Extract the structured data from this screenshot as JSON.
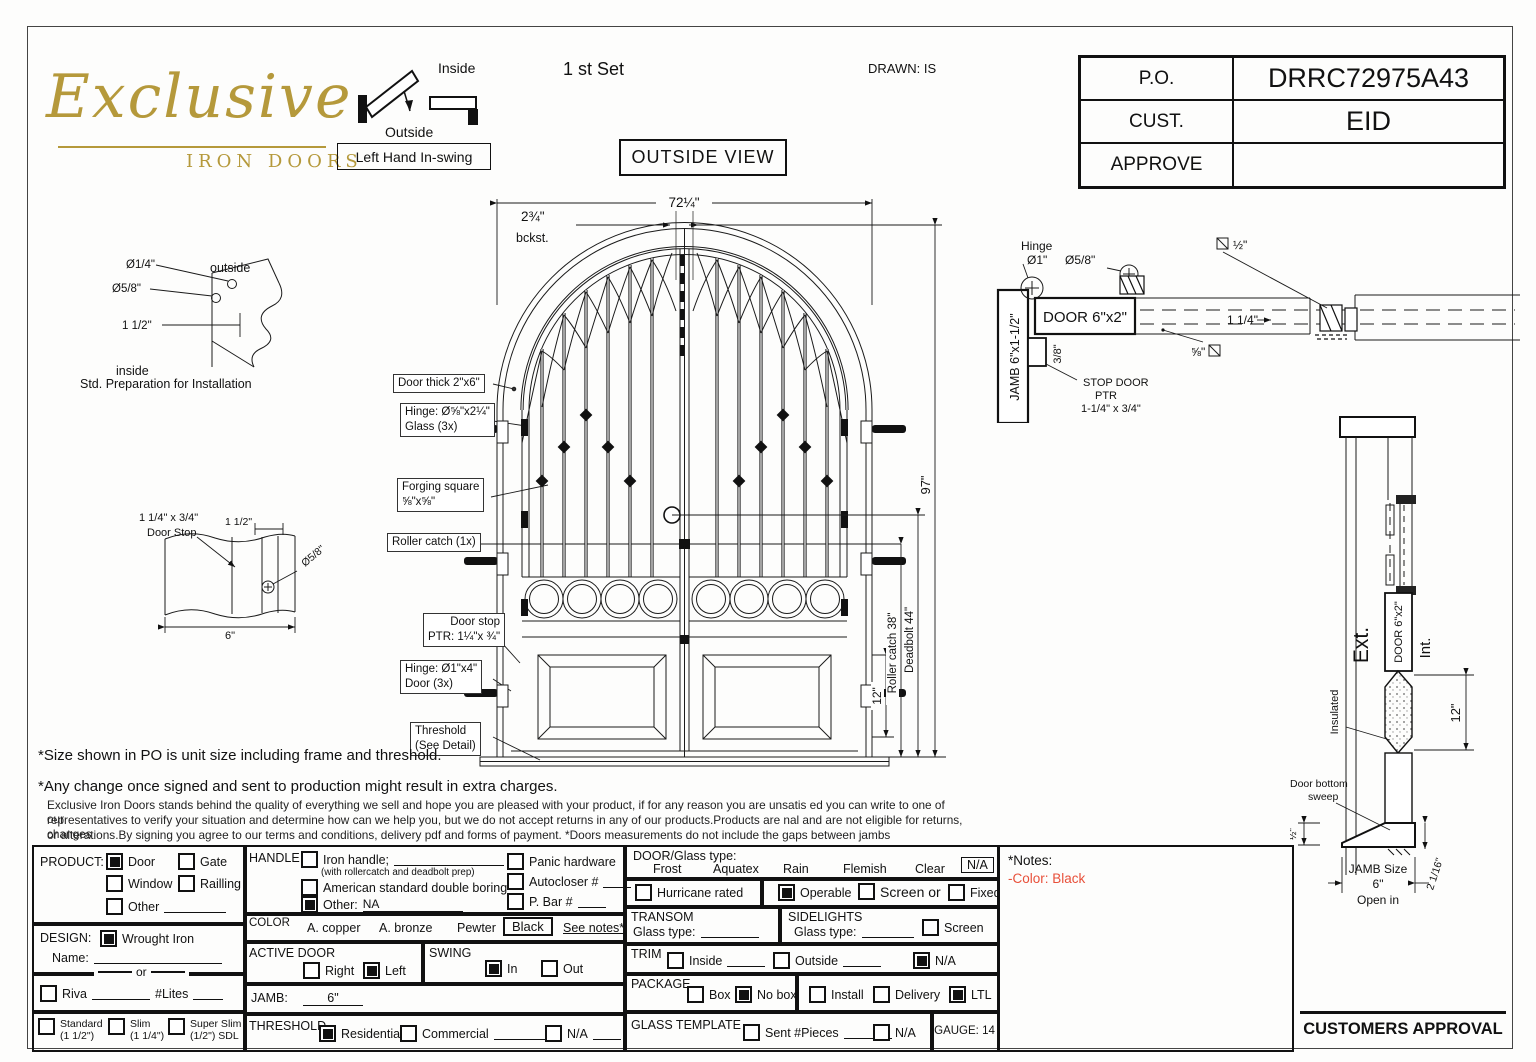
{
  "logo": {
    "script": "Exclusive",
    "sub": "IRON DOORS"
  },
  "swing_diagram": {
    "inside": "Inside",
    "outside": "Outside",
    "handing": "Left Hand In-swing"
  },
  "header": {
    "set": "1 st Set",
    "drawn": "DRAWN: IS",
    "view": "OUTSIDE VIEW"
  },
  "po": {
    "r0l": "P.O.",
    "r0v": "DRRC72975A43",
    "r1l": "CUST.",
    "r1v": "EID",
    "r2l": "APPROVE",
    "r2v": ""
  },
  "install_detail": {
    "d1": "Ø1/4\"",
    "d2": "Ø5/8\"",
    "d3": "1 1/2\"",
    "outside": "outside",
    "inside": "inside",
    "caption": "Std. Preparation for Installation"
  },
  "stop_detail": {
    "l1": "1 1/4\" x 3/4\"",
    "l2": "Door Stop",
    "d1": "1 1/2\"",
    "d2": "Ø5/8\"",
    "d3": "6\""
  },
  "door": {
    "dim_width": "72¼\"",
    "dim_backset": "2¾\"",
    "backset_label": "bckst.",
    "dim_height": "97\"",
    "dim_roller": "Roller catch 38\"",
    "dim_deadbolt": "Deadbolt 44\"",
    "dim_panel": "12\"",
    "c1": "Door thick 2\"x6\"",
    "c2a": "Hinge: Ø⅝\"x2¼\"",
    "c2b": "Glass (3x)",
    "c3a": "Forging square",
    "c3b": "⅝\"x⅝\"",
    "c4": "Roller catch  (1x)",
    "c5a": "Door stop",
    "c5b": "PTR: 1¼\"x ¾\"",
    "c6a": "Hinge: Ø1\"x4\"",
    "c6b": "Door (3x)",
    "c7a": "Threshold",
    "c7b": "(See Detail)"
  },
  "plan": {
    "hinge": "Hinge",
    "hinge_dia": "Ø1\"",
    "dia58": "Ø5/8\"",
    "door": "DOOR 6\"x2\"",
    "jamb": "JAMB 6\"x1-1/2\"",
    "dim38": "3/8\"",
    "stop1": "STOP DOOR",
    "stop2": "PTR",
    "stop3": "1-1/4\" x 3/4\"",
    "dim114": "1 1/4\"",
    "dim12": "½\"",
    "dim58sq": "⅝\""
  },
  "section": {
    "ext": "Ext.",
    "int": "Int.",
    "door": "DOOR 6\"x2\"",
    "insulated": "Insulated",
    "dim12": "12\"",
    "sweep1": "Door bottom",
    "sweep2": "sweep",
    "dimhalf": "½\"",
    "jamb1": "JAMB Size",
    "jamb2": "6\"",
    "jamb3": "Open in",
    "dim216": "2 1/16\""
  },
  "disclaimer": {
    "l1": "*Size shown in PO is unit size including frame and threshold.",
    "l2": "*Any change once signed and sent to production might result in extra charges.",
    "p1": "Exclusive Iron Doors stands behind the quality of everything we sell and hope you are pleased with your product, if for any reason you are unsatis ed you can write to one of our",
    "p2": "representatives to verify your situation and determine how can we help you, but we do not accept returns in any of our products.Products are  nal and are not eligible for returns, changes",
    "p3": "or alterations.By signing you agree to our terms and conditions, delivery pdf and forms of payment. *Doors measurements do not include the gaps between jambs"
  },
  "form": {
    "product": {
      "label": "PRODUCT:",
      "door": {
        "label": "Door",
        "checked": true
      },
      "gate": {
        "label": "Gate",
        "checked": false
      },
      "window": {
        "label": "Window",
        "checked": false
      },
      "railling": {
        "label": "Railling",
        "checked": false
      },
      "other": {
        "label": "Other",
        "checked": false
      }
    },
    "design": {
      "label": "DESIGN:",
      "wrought": {
        "label": "Wrought Iron",
        "checked": true
      },
      "name": "Name:",
      "or": "or"
    },
    "riva": {
      "label": "Riva",
      "checked": false,
      "lites": "#Lites"
    },
    "standard": {
      "label": "Standard",
      "sub": "(1 1/2\")",
      "checked": false
    },
    "slim": {
      "label": "Slim",
      "sub": "(1 1/4\")",
      "checked": false
    },
    "superslim": {
      "label": "Super Slim",
      "sub": "(1/2\") SDL",
      "checked": false
    },
    "handle": {
      "label": "HANDLE",
      "iron": {
        "label": "Iron handle;",
        "checked": false
      },
      "iron_sub": "(with rollercatch and deadbolt prep)",
      "american": {
        "label": "American standard double boring",
        "checked": false
      },
      "other": {
        "label": "Other:",
        "value": "NA",
        "checked": true
      },
      "panic": {
        "label": "Panic hardware",
        "checked": false
      },
      "autocloser": {
        "label": "Autocloser #",
        "checked": false
      },
      "pbar": {
        "label": "P. Bar #",
        "checked": false
      }
    },
    "color": {
      "label": "COLOR",
      "o1": "A. copper",
      "o2": "A. bronze",
      "o3": "Pewter",
      "selected": "Black",
      "see": "See notes*"
    },
    "active": {
      "label": "ACTIVE DOOR",
      "right": {
        "label": "Right",
        "checked": false
      },
      "left": {
        "label": "Left",
        "checked": true
      }
    },
    "swing": {
      "label": "SWING",
      "in": {
        "label": "In",
        "checked": true
      },
      "out": {
        "label": "Out",
        "checked": false
      }
    },
    "jamb": {
      "label": "JAMB:",
      "value": "6\""
    },
    "threshold": {
      "label": "THRESHOLD",
      "res": {
        "label": "Residential",
        "checked": true
      },
      "com": {
        "label": "Commercial",
        "checked": false
      },
      "na": {
        "label": "N/A",
        "checked": false
      }
    },
    "glass": {
      "label": "DOOR/Glass type:",
      "o1": "Frost",
      "o2": "Aquatex",
      "o3": "Rain",
      "o4": "Flemish",
      "o5": "Clear",
      "na": "N/A"
    },
    "hurricane": {
      "label": "Hurricane rated",
      "checked": false
    },
    "operable": {
      "label": "Operable",
      "checked": true
    },
    "screen_or": {
      "label": "Screen or",
      "checked": false
    },
    "fixed": {
      "label": "Fixed",
      "checked": false
    },
    "transom": {
      "label": "TRANSOM",
      "glass": "Glass type:"
    },
    "sidelights": {
      "label": "SIDELIGHTS",
      "glass": "Glass type:",
      "screen": {
        "label": "Screen",
        "checked": false
      }
    },
    "trim": {
      "label": "TRIM",
      "inside": {
        "label": "Inside",
        "checked": false
      },
      "outside": {
        "label": "Outside",
        "checked": false
      },
      "na": {
        "label": "N/A",
        "checked": true
      }
    },
    "package": {
      "label": "PACKAGE",
      "box": {
        "label": "Box",
        "checked": false
      },
      "nobox": {
        "label": "No box",
        "checked": true
      },
      "install": {
        "label": "Install",
        "checked": false
      },
      "delivery": {
        "label": "Delivery",
        "checked": false
      },
      "ltl": {
        "label": "LTL",
        "checked": true
      }
    },
    "template": {
      "label": "GLASS TEMPLATE",
      "sent": {
        "label": "Sent #Pieces",
        "checked": false
      },
      "na": {
        "label": "N/A",
        "checked": false
      }
    },
    "gauge": "GAUGE: 14",
    "notes": {
      "title": "*Notes:",
      "note": "-Color: Black",
      "note_color": "#e8503a"
    }
  },
  "footer": {
    "approval": "CUSTOMERS APPROVAL"
  }
}
